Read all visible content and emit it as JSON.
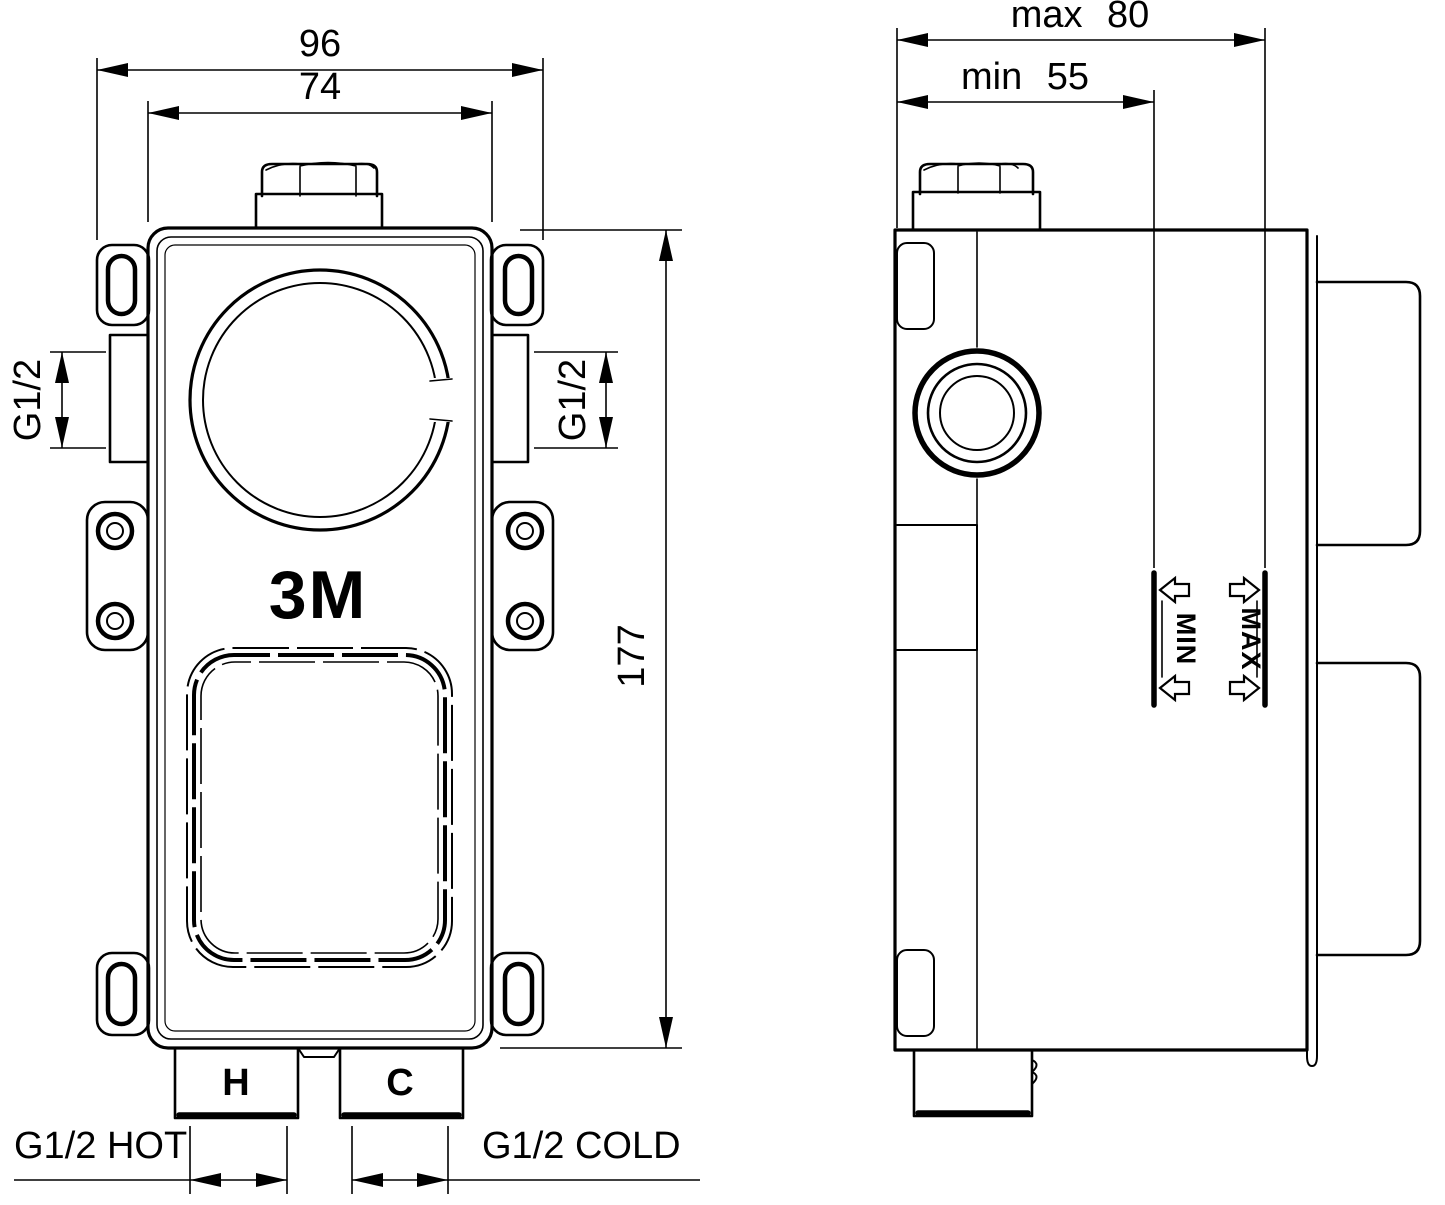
{
  "drawing": {
    "front_view": {
      "dim_overall_width": "96",
      "dim_body_width": "74",
      "dim_body_height": "177",
      "side_port_left": "G1/2",
      "side_port_right": "G1/2",
      "brand": "3M",
      "hot_port_mark": "H",
      "cold_port_mark": "C",
      "hot_label": "G1/2 HOT",
      "cold_label": "G1/2 COLD"
    },
    "side_view": {
      "dim_depth_max": "max 80",
      "dim_depth_min": "min 55",
      "marker_min": "MIN",
      "marker_max": "MAX"
    },
    "colors": {
      "line": "#000000",
      "background": "#ffffff"
    }
  }
}
